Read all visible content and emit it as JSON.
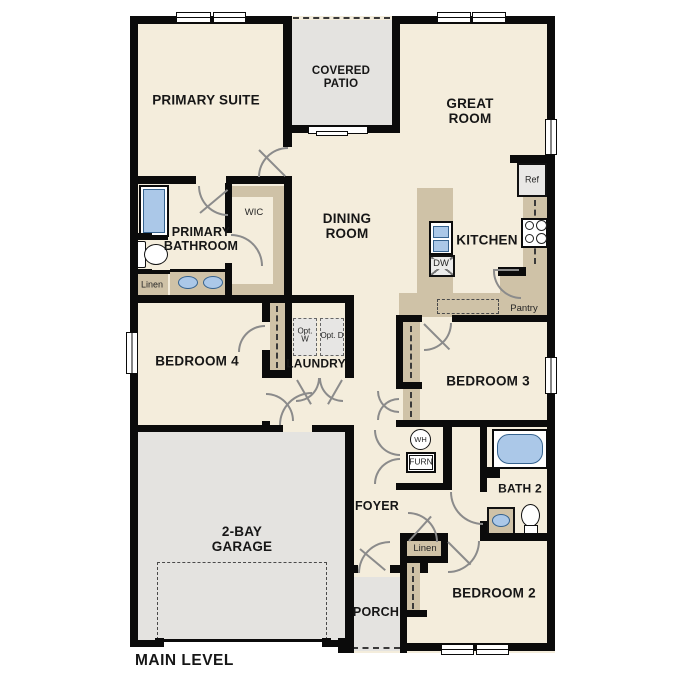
{
  "plan_title": "MAIN LEVEL",
  "rooms": {
    "primary_suite": "PRIMARY SUITE",
    "covered_patio": "COVERED PATIO",
    "great_room": "GREAT ROOM",
    "primary_bathroom": "PRIMARY BATHROOM",
    "wic": "WIC",
    "dining_room": "DINING ROOM",
    "kitchen": "KITCHEN",
    "bedroom_4": "BEDROOM 4",
    "laundry": "LAUNDRY",
    "bedroom_3": "BEDROOM 3",
    "bath_2": "BATH 2",
    "garage": "2-BAY GARAGE",
    "foyer": "FOYER",
    "porch": "PORCH",
    "bedroom_2": "BEDROOM 2"
  },
  "fixtures": {
    "refrigerator": "Ref",
    "dishwasher": "DW",
    "pantry": "Pantry",
    "linen_bathroom": "Linen",
    "linen_hall": "Linen",
    "optional_washer": "Opt. W",
    "optional_dryer": "Opt. D",
    "water_heater": "WH",
    "furnace": "FURN"
  },
  "colors": {
    "interior_floor": "#f4eddc",
    "outdoor_concrete": "#e4e3e0",
    "cabinetry": "#cfc2a7",
    "plumbing_fixture": "#abc8e8",
    "wall": "#0b0b0b"
  }
}
